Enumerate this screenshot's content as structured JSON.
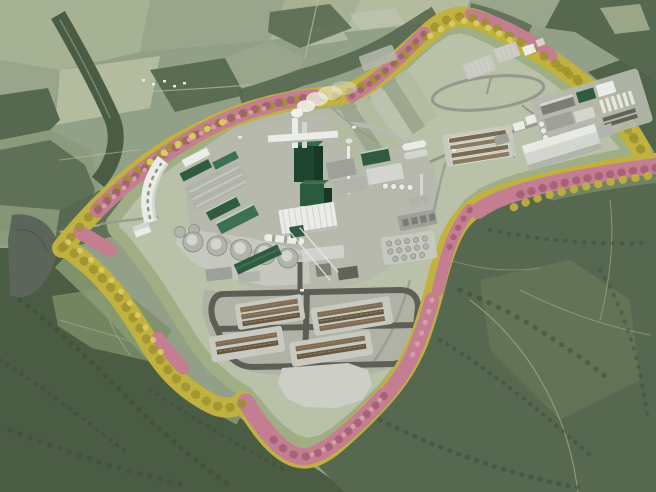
{
  "description": "Aerial 3D visualization render of a planned pulp mill industrial site surrounded by an autumn-colored (yellow and pink) tree screen, set in a forested rural landscape with farmland to the north, a small lake to the west, dense forest to the south and east, a central mill with ring road, green boiler tower with steam stacks, storage tanks, log storage yard, water treatment cluster and open reserve land with an oval loop road.",
  "colors": {
    "base": "#93a088",
    "fieldLight": "#a7b193",
    "fieldLighter": "#b3bc9e",
    "fieldPale": "#bdc2ae",
    "fieldMid": "#9aa68c",
    "fieldDark": "#8a9a7a",
    "forestDark": "#4b5c44",
    "forestMid": "#566850",
    "forestDeep": "#3c4c37",
    "forestBlob": "#5a6c52",
    "meadow": "#7d8f68",
    "meadowLight": "#8a9b72",
    "trailLight": "#9aa585",
    "roadFaint": "#b7bea6",
    "lake": "#5b655a",
    "verge": "#9fae85",
    "platform": "#b9c2a8",
    "platformGray": "#b5b8ac",
    "woodYardGround": "#afb2a5",
    "padLight": "#c8cac1",
    "padLighter": "#cdcfc6",
    "treeYellow": "#c1b13e",
    "treeYellowDark": "#9c9130",
    "treeYellowLight": "#dacd64",
    "treePink": "#c37e91",
    "treePinkDark": "#a15b70",
    "treePinkLight": "#daa2af",
    "roadMid": "#95988e",
    "roadDark": "#5d5f56",
    "roadLight": "#b6b9af",
    "bldgWhite": "#eaece7",
    "bldgLight": "#d3d6ce",
    "bldgGray": "#b0b4ab",
    "bldgMidGray": "#9da19a",
    "bldgDarkGray": "#7a7e74",
    "bldgDeep": "#5f6359",
    "roofGreen": "#2f5c40",
    "roofGreenLight": "#3e7151",
    "boilerGreen": "#1d4530",
    "boilerGreenMid": "#2a5b3e",
    "boilerGreenTop": "#356a4a",
    "boilerGreenDark": "#163926",
    "steam": "#f3f4f1",
    "logBrown": "#7e6b52",
    "logBrownDark": "#675740",
    "logBrownLight": "#9b8869",
    "basinBrown": "#7a6a50",
    "basinBrown2": "#8a7a5e"
  }
}
